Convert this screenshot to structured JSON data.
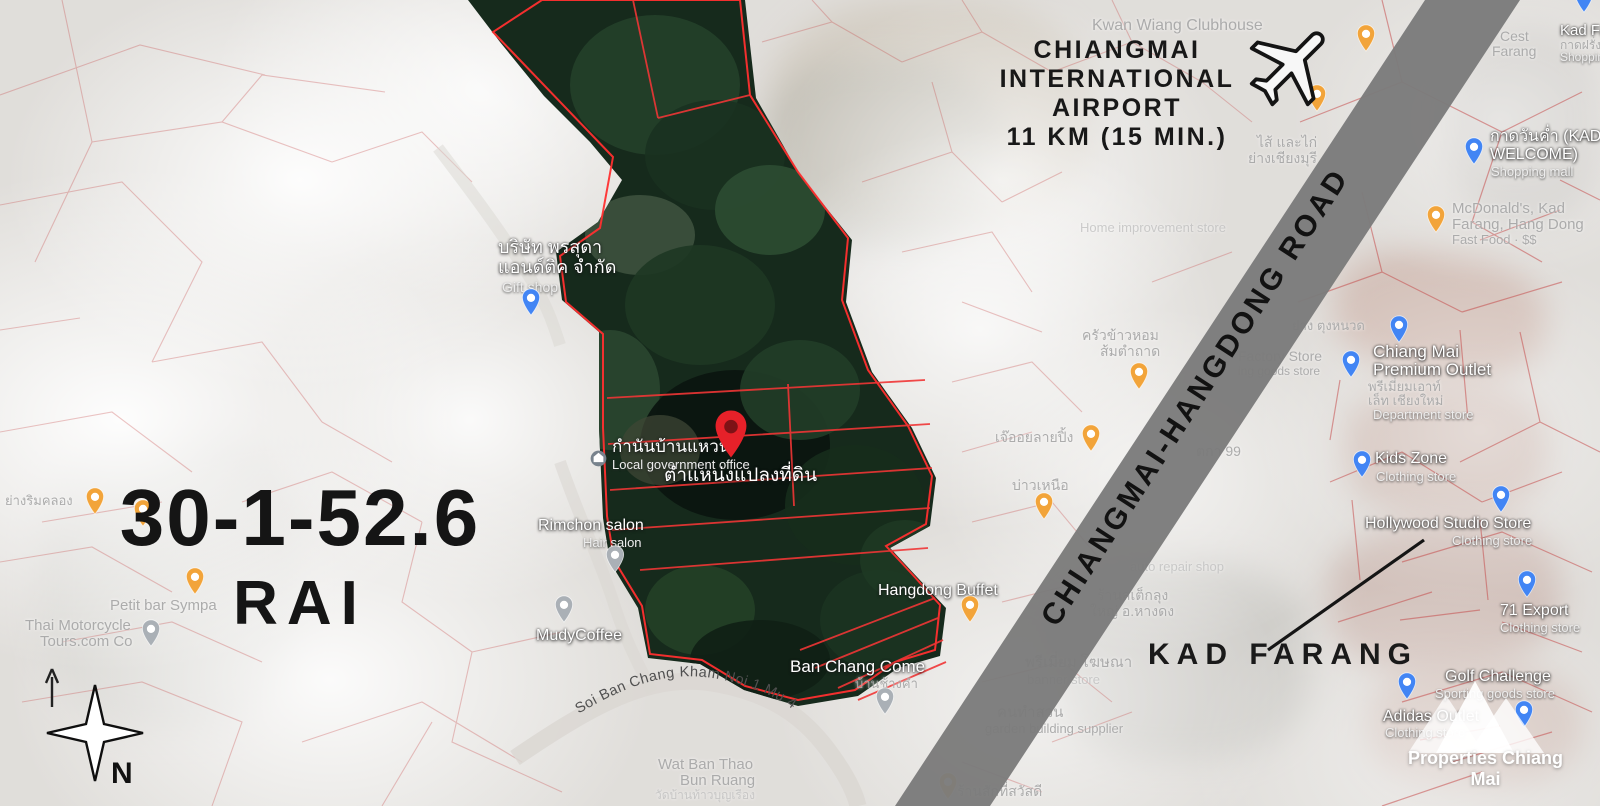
{
  "title": {
    "line1": "30-1-52.6",
    "line2": "RAI"
  },
  "airport": {
    "line1": "CHIANGMAI",
    "line2": "INTERNATIONAL",
    "line3": "AIRPORT",
    "line4": "11 KM (15 MIN.)"
  },
  "road_band": {
    "label": "CHIANGMAI-HANGDONG ROAD"
  },
  "kad_farang": {
    "label": "KAD FARANG"
  },
  "compass": {
    "north": "N"
  },
  "watermark": {
    "label": "Properties Chiang Mai"
  },
  "soi": {
    "label": "Soi Ban Chang Kham Noi 1 Mu 4"
  },
  "colors": {
    "accent_red": "#e62129",
    "cadastral_red": "#c44040",
    "road_band_gray": "#7b7b7b",
    "pin_blue": "#4285f4",
    "pin_yellow": "#f2a43a",
    "pin_gray": "#aab0b6",
    "text_black": "#151515"
  },
  "map_labels": [
    {
      "text": "Kwan Wiang Clubhouse",
      "x": 1092,
      "y": 18,
      "fs": 16,
      "cls": "f"
    },
    {
      "text": "บริษัท พรสุดา",
      "x": 498,
      "y": 238,
      "fs": 18,
      "cls": "w"
    },
    {
      "text": "แอนด์ติค จำกัด",
      "x": 498,
      "y": 258,
      "fs": 18,
      "cls": "w"
    },
    {
      "text": "Gift shop",
      "x": 502,
      "y": 280,
      "fs": 14,
      "cls": "sub"
    },
    {
      "text": "กำนันบ้านแหวน",
      "x": 612,
      "y": 438,
      "fs": 17,
      "cls": "w"
    },
    {
      "text": "Local government office",
      "x": 612,
      "y": 458,
      "fs": 13,
      "cls": "sub"
    },
    {
      "text": "ตำแหน่งแปลงที่ดิน",
      "x": 664,
      "y": 466,
      "fs": 19,
      "cls": "w"
    },
    {
      "text": "Rimchon salon",
      "x": 538,
      "y": 518,
      "fs": 16,
      "cls": "w"
    },
    {
      "text": "Hair salon",
      "x": 583,
      "y": 536,
      "fs": 13,
      "cls": "sub"
    },
    {
      "text": "MudyCoffee",
      "x": 536,
      "y": 628,
      "fs": 16,
      "cls": "w"
    },
    {
      "text": "Hangdong Buffet",
      "x": 878,
      "y": 583,
      "fs": 16,
      "cls": "w"
    },
    {
      "text": "Ban Chang Come",
      "x": 790,
      "y": 658,
      "fs": 17,
      "cls": "w"
    },
    {
      "text": "บ้านช้างคำ",
      "x": 855,
      "y": 677,
      "fs": 13,
      "cls": "f"
    },
    {
      "text": "Wat Ban Thao",
      "x": 658,
      "y": 757,
      "fs": 15,
      "cls": "f"
    },
    {
      "text": "Bun Ruang",
      "x": 680,
      "y": 773,
      "fs": 15,
      "cls": "f"
    },
    {
      "text": "วัดบ้านท้าวบุญเรือง",
      "x": 655,
      "y": 789,
      "fs": 12,
      "cls": "ff"
    },
    {
      "text": "Petit bar Sympa",
      "x": 110,
      "y": 598,
      "fs": 15,
      "cls": "f"
    },
    {
      "text": "Thai Motorcycle",
      "x": 25,
      "y": 618,
      "fs": 15,
      "cls": "f"
    },
    {
      "text": "Tours.com Co",
      "x": 40,
      "y": 634,
      "fs": 15,
      "cls": "f"
    },
    {
      "text": "ย่างริมคลอง",
      "x": 5,
      "y": 494,
      "fs": 13,
      "cls": "f"
    },
    {
      "text": "ครัวข้าวหอม",
      "x": 1082,
      "y": 328,
      "fs": 14,
      "cls": "f"
    },
    {
      "text": "ส้มตำถาด",
      "x": 1100,
      "y": 344,
      "fs": 14,
      "cls": "f"
    },
    {
      "text": "เจ๊ออยลายปิ้ง",
      "x": 995,
      "y": 430,
      "fs": 14,
      "cls": "f"
    },
    {
      "text": "บ่าวเหนือ",
      "x": 1012,
      "y": 478,
      "fs": 14,
      "cls": "f"
    },
    {
      "text": "ตกา 99",
      "x": 1196,
      "y": 444,
      "fs": 14,
      "cls": "f"
    },
    {
      "text": "auto repair shop",
      "x": 1130,
      "y": 560,
      "fs": 13,
      "cls": "ff"
    },
    {
      "text": "ร้านสเต็กลุง",
      "x": 1097,
      "y": 588,
      "fs": 14,
      "cls": "f"
    },
    {
      "text": "ใหญ่ อ.หางดง",
      "x": 1090,
      "y": 604,
      "fs": 14,
      "cls": "f"
    },
    {
      "text": "พรีเมี่ยม โฆษณา",
      "x": 1025,
      "y": 655,
      "fs": 15,
      "cls": "f"
    },
    {
      "text": "banner store",
      "x": 1027,
      "y": 673,
      "fs": 13,
      "cls": "ff"
    },
    {
      "text": "คนทำสวน",
      "x": 997,
      "y": 705,
      "fs": 15,
      "cls": "f"
    },
    {
      "text": "garden building supplier",
      "x": 985,
      "y": 722,
      "fs": 13,
      "cls": "f"
    },
    {
      "text": "ร้านสักที่สวัสดี",
      "x": 957,
      "y": 784,
      "fs": 14,
      "cls": "f"
    },
    {
      "text": "Home improvement store",
      "x": 1080,
      "y": 221,
      "fs": 13,
      "cls": "ff"
    },
    {
      "text": "ไส้ และไก่",
      "x": 1257,
      "y": 135,
      "fs": 14,
      "cls": "f"
    },
    {
      "text": "ย่างเชียงมุรี",
      "x": 1248,
      "y": 151,
      "fs": 14,
      "cls": "f"
    },
    {
      "text": "ย่าง ตุงหนวด",
      "x": 1292,
      "y": 319,
      "fs": 13,
      "cls": "f"
    },
    {
      "text": "Factory Store",
      "x": 1238,
      "y": 349,
      "fs": 14,
      "cls": "f"
    },
    {
      "text": "ing goods store",
      "x": 1238,
      "y": 365,
      "fs": 12,
      "cls": "f"
    },
    {
      "text": "Chiang Mai",
      "x": 1373,
      "y": 343,
      "fs": 17,
      "cls": "w"
    },
    {
      "text": "Premium Outlet",
      "x": 1373,
      "y": 361,
      "fs": 17,
      "cls": "w"
    },
    {
      "text": "พรีเมี่ยมเอาท์",
      "x": 1368,
      "y": 380,
      "fs": 13,
      "cls": "f"
    },
    {
      "text": "เล็ท เชียงใหม่",
      "x": 1368,
      "y": 394,
      "fs": 13,
      "cls": "f"
    },
    {
      "text": "Department store",
      "x": 1373,
      "y": 408,
      "fs": 13,
      "cls": "sub"
    },
    {
      "text": "Kids Zone",
      "x": 1375,
      "y": 451,
      "fs": 16,
      "cls": "w"
    },
    {
      "text": "Clothing store",
      "x": 1376,
      "y": 470,
      "fs": 13,
      "cls": "sub"
    },
    {
      "text": "Hollywood Studio Store",
      "x": 1365,
      "y": 516,
      "fs": 16,
      "cls": "w"
    },
    {
      "text": "Clothing store",
      "x": 1452,
      "y": 534,
      "fs": 13,
      "cls": "sub"
    },
    {
      "text": "71 Export",
      "x": 1500,
      "y": 603,
      "fs": 16,
      "cls": "w"
    },
    {
      "text": "Clothing store",
      "x": 1500,
      "y": 621,
      "fs": 13,
      "cls": "sub"
    },
    {
      "text": "Golf Challenge",
      "x": 1445,
      "y": 669,
      "fs": 16,
      "cls": "w"
    },
    {
      "text": "Sporting goods store",
      "x": 1435,
      "y": 687,
      "fs": 13,
      "cls": "sub"
    },
    {
      "text": "Adidas Outlet",
      "x": 1383,
      "y": 709,
      "fs": 16,
      "cls": "w"
    },
    {
      "text": "Clothing store",
      "x": 1385,
      "y": 726,
      "fs": 13,
      "cls": "sub"
    },
    {
      "text": "Cest",
      "x": 1500,
      "y": 29,
      "fs": 14,
      "cls": "f"
    },
    {
      "text": "Farang",
      "x": 1492,
      "y": 44,
      "fs": 14,
      "cls": "f"
    },
    {
      "text": "Kad Farang",
      "x": 1560,
      "y": 23,
      "fs": 15,
      "cls": "w"
    },
    {
      "text": "กาดฝรั่ง",
      "x": 1560,
      "y": 39,
      "fs": 12,
      "cls": "f"
    },
    {
      "text": "Shopping mall",
      "x": 1560,
      "y": 51,
      "fs": 12,
      "cls": "sub"
    },
    {
      "text": "กาดวันค่ำ (KAD",
      "x": 1490,
      "y": 129,
      "fs": 16,
      "cls": "w"
    },
    {
      "text": "WELCOME)",
      "x": 1490,
      "y": 147,
      "fs": 16,
      "cls": "w"
    },
    {
      "text": "Shopping mall",
      "x": 1491,
      "y": 165,
      "fs": 13,
      "cls": "sub"
    },
    {
      "text": "McDonald's, Kad",
      "x": 1452,
      "y": 201,
      "fs": 15,
      "cls": "f"
    },
    {
      "text": "Farang, Hang Dong",
      "x": 1452,
      "y": 217,
      "fs": 15,
      "cls": "f"
    },
    {
      "text": "Fast Food · $$",
      "x": 1452,
      "y": 233,
      "fs": 13,
      "cls": "f"
    }
  ],
  "map_pins": [
    {
      "type": "shop",
      "x": 531,
      "y": 316
    },
    {
      "type": "gen",
      "x": 615,
      "y": 573
    },
    {
      "type": "gen",
      "x": 564,
      "y": 623
    },
    {
      "type": "food",
      "x": 970,
      "y": 623
    },
    {
      "type": "gen",
      "x": 885,
      "y": 715
    },
    {
      "type": "shop",
      "x": 1399,
      "y": 343
    },
    {
      "type": "shop",
      "x": 1351,
      "y": 378
    },
    {
      "type": "shop",
      "x": 1362,
      "y": 478
    },
    {
      "type": "shop",
      "x": 1501,
      "y": 513
    },
    {
      "type": "shop",
      "x": 1527,
      "y": 598
    },
    {
      "type": "shop",
      "x": 1407,
      "y": 700
    },
    {
      "type": "shop",
      "x": 1524,
      "y": 728
    },
    {
      "type": "shop",
      "x": 1474,
      "y": 165
    },
    {
      "type": "food",
      "x": 1436,
      "y": 233
    },
    {
      "type": "shop",
      "x": 1584,
      "y": 13
    },
    {
      "type": "food",
      "x": 1366,
      "y": 52
    },
    {
      "type": "food",
      "x": 1317,
      "y": 112
    },
    {
      "type": "food",
      "x": 1139,
      "y": 390
    },
    {
      "type": "food",
      "x": 1091,
      "y": 452
    },
    {
      "type": "food",
      "x": 1044,
      "y": 520
    },
    {
      "type": "food",
      "x": 95,
      "y": 515
    },
    {
      "type": "food",
      "x": 143,
      "y": 527
    },
    {
      "type": "food",
      "x": 195,
      "y": 595
    },
    {
      "type": "gen",
      "x": 151,
      "y": 647
    },
    {
      "type": "food",
      "x": 948,
      "y": 800
    },
    {
      "type": "gov",
      "x": 598,
      "y": 458
    },
    {
      "type": "target",
      "x": 731,
      "y": 459
    }
  ]
}
